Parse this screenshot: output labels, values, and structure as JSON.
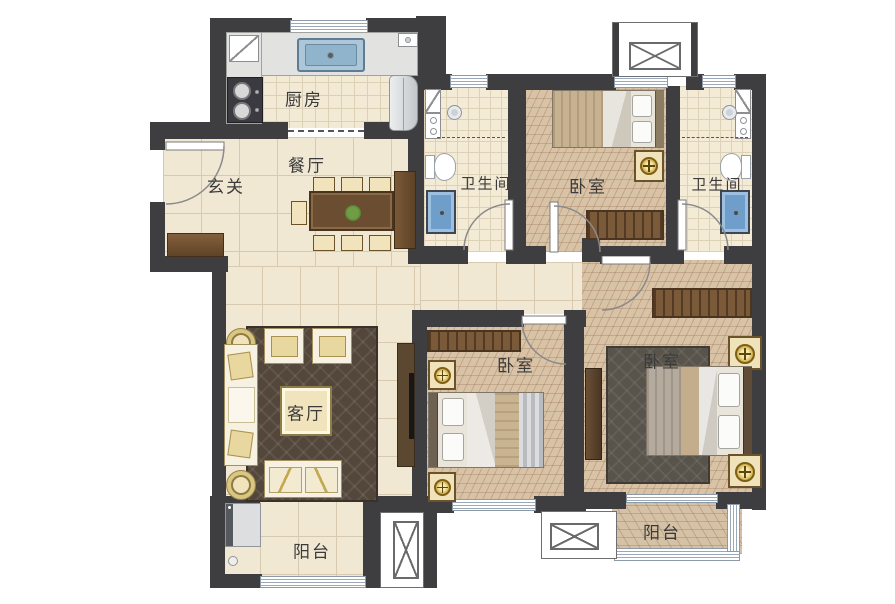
{
  "rooms": {
    "kitchen": "厨房",
    "dining": "餐厅",
    "foyer": "玄关",
    "bathroom_1": "卫生间",
    "bedroom_top": "卧室",
    "bathroom_2": "卫生间",
    "living": "客厅",
    "bedroom_middle": "卧室",
    "bedroom_right": "卧室",
    "balcony_left": "阳台",
    "balcony_right": "阳台"
  },
  "colors": {
    "wall": "#3e3d40",
    "floor_tile": "#f1e8d3",
    "wood_floor": "#d9c3a7",
    "water_fixture_blue": "#6f9ecb",
    "furniture_brown": "#6b4e31",
    "label_text": "#3b3b3b"
  }
}
